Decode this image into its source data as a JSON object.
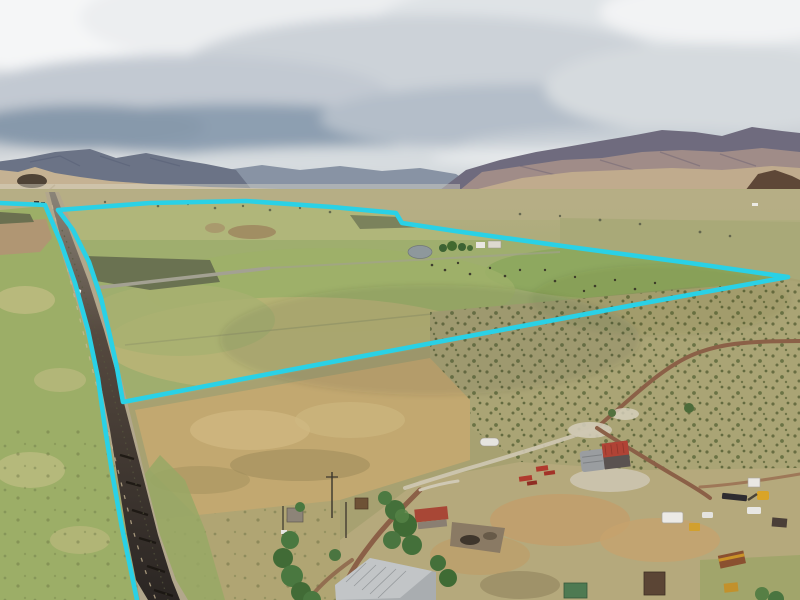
{
  "meta": {
    "kind": "aerial-drone-photograph",
    "subject": "rural ranch land parcel with property boundary outline overlay",
    "setting": "high-desert valley with mountain backdrop, pastures, highway and farmstead"
  },
  "overlay": {
    "boundary_color": "#2AD1E6",
    "boundary_stroke_width": "4.6",
    "parcel_outline_points": "58,210 150,203 246,201 332,207 396,213 402,223 455,231 570,247 690,263 788,277 650,302 480,334 300,368 180,391 123,402 117,368 110,336 101,298 89,262 73,230 58,210",
    "west_boundary_points": "0,203 45,205 61,243 75,283 88,330 98,378 105,428 113,478 122,528 130,566 137,600"
  },
  "palette": {
    "sky_base": "#cfd4d8",
    "cloud_bright": "#f3f4f5",
    "cloud_dark": "#8496a9",
    "mountain_left": "#6b7386",
    "mountain_distant": "#8893a4",
    "mountain_right_upper": "#6f6b7e",
    "mountain_right_slope": "#a5908a",
    "foothills_tan": "#c5b293",
    "dark_hill": "#5e4737",
    "pasture_green": "#9cae67",
    "parcel_green": "#9fae6e",
    "dry_field_tan": "#c2a870",
    "sagebrush_plain": "#a7a171",
    "farmyard_dust": "#b5a97c",
    "dirt_road": "#8b6047",
    "asphalt": "#2e2927",
    "barn_roof_red": "#b04335",
    "barn_roof_silver": "#c2c5c7"
  },
  "objects": {
    "highway": "paved county road running from horizon to bottom edge",
    "main_barn": "gray barn with red metal roof section",
    "old_farmstead": "weathered barns, red-roof cabin, silver-roof barn, trees",
    "equipment": "excavator, loader, trailers, trucks, rust dumpster",
    "pond": "small stock pond inside parcel",
    "cattle": "scattered livestock dots in pasture"
  }
}
